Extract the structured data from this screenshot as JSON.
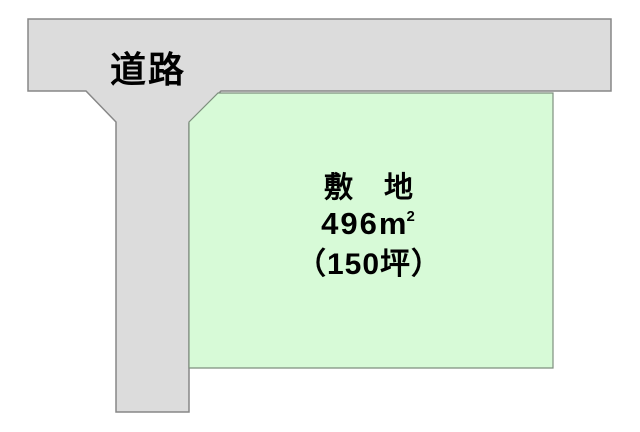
{
  "diagram": {
    "title": "land-plot-with-road-diagram",
    "road": {
      "label": "道路"
    },
    "plot": {
      "name": "敷　地",
      "area_value": "496",
      "area_unit": "m",
      "area_exponent": "2",
      "area_tsubo": "（150坪）"
    }
  },
  "colors": {
    "background": "#ffffff",
    "road_fill": "#dcdcdc",
    "road_border": "#878787",
    "plot_fill": "#d7fad7",
    "plot_border": "#7e8f7e"
  }
}
